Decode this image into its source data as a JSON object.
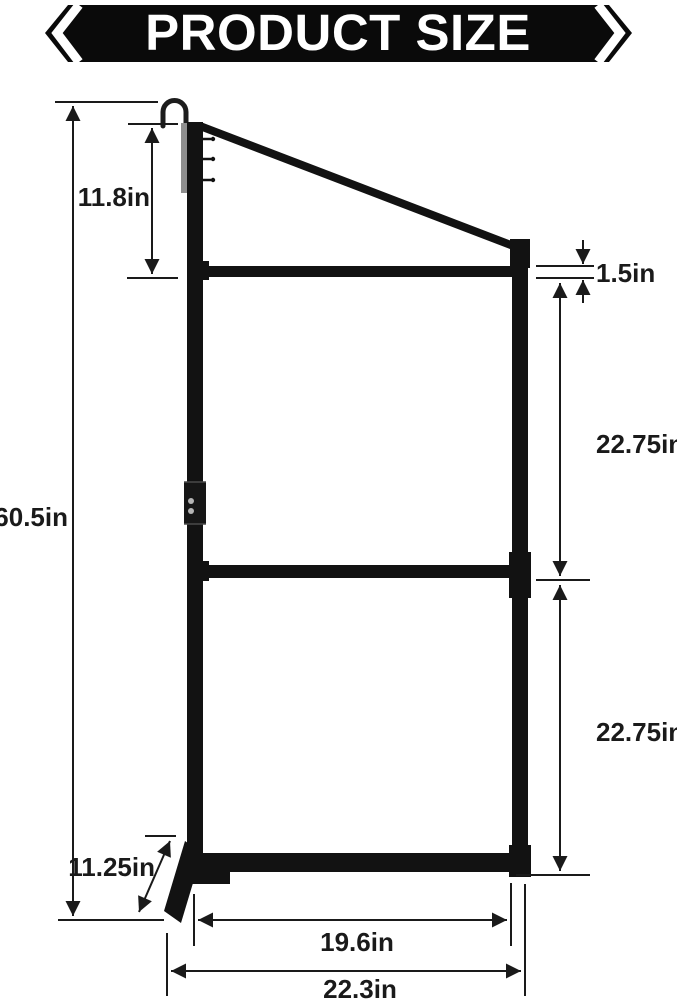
{
  "banner": {
    "title": "PRODUCT SIZE",
    "bg_color": "#0a0a0a",
    "text_color": "#ffffff"
  },
  "diagram": {
    "product": "hanging rack frame with hook, three crossbars and angled base foot",
    "unit": "in",
    "line_color": "#1a1a1a",
    "frame_color": "#121212",
    "dimensions": {
      "total_height": "60.5in",
      "hook_to_top_bar": "11.8in",
      "bar_thickness": "1.5in",
      "upper_section": "22.75in",
      "lower_section": "22.75in",
      "base_foot_depth": "11.25in",
      "inner_width": "19.6in",
      "overall_width": "22.3in"
    }
  }
}
